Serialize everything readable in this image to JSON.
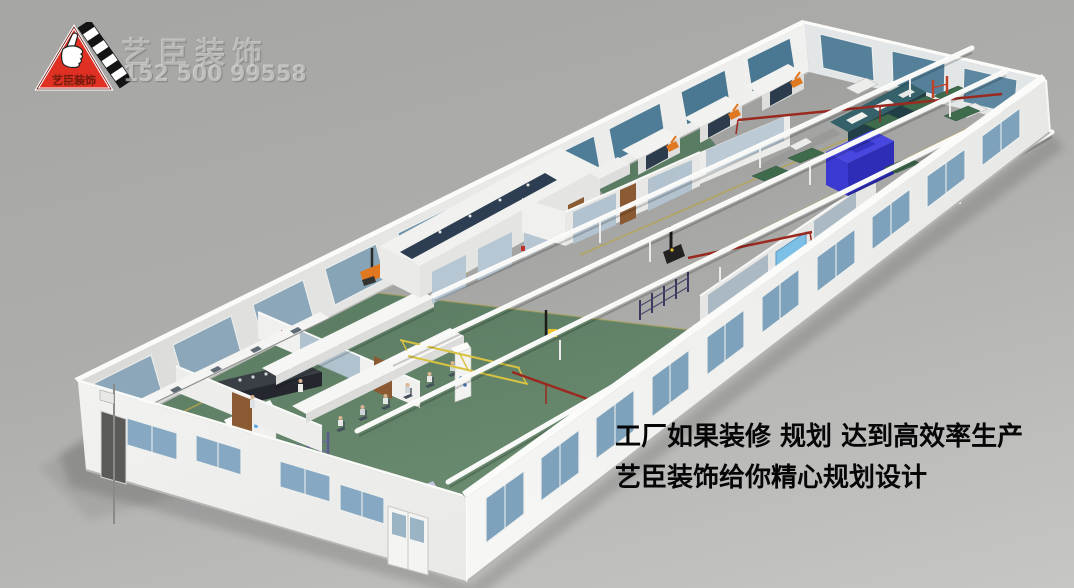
{
  "branding": {
    "logo_text": "艺臣装饰",
    "logo_colors": {
      "triangle": "#e03024",
      "keys": "#141414",
      "text": "#ffd200",
      "outline": "#ffffff"
    },
    "watermark_name": "艺臣装饰",
    "watermark_phone": "152 500 99558"
  },
  "slogan": {
    "line1": "工厂如果装修 规划 达到高效率生产",
    "line2": "艺臣装饰给你精心规划设计"
  },
  "scene": {
    "type": "3d-factory-interior-layout-rendering",
    "palette": {
      "background": "#ababa9",
      "floor_gray": "#a4a4a2",
      "floor_green": "#5e8067",
      "wall_white": "#f2f2f0",
      "window_glass_blue": "#7fa2bc",
      "window_glass_teal": "#4f7c96",
      "roof_beam_white": "#f8f8f6",
      "pipe_red": "#9a2a20",
      "machine_blue": "#3b36cf",
      "machine_teal": "#35616b",
      "robot_orange": "#e07820",
      "lane_line_yellow": "#b5a54e",
      "door_wood": "#8a5a32",
      "roller_door_blue": "#7cc0e8"
    }
  }
}
